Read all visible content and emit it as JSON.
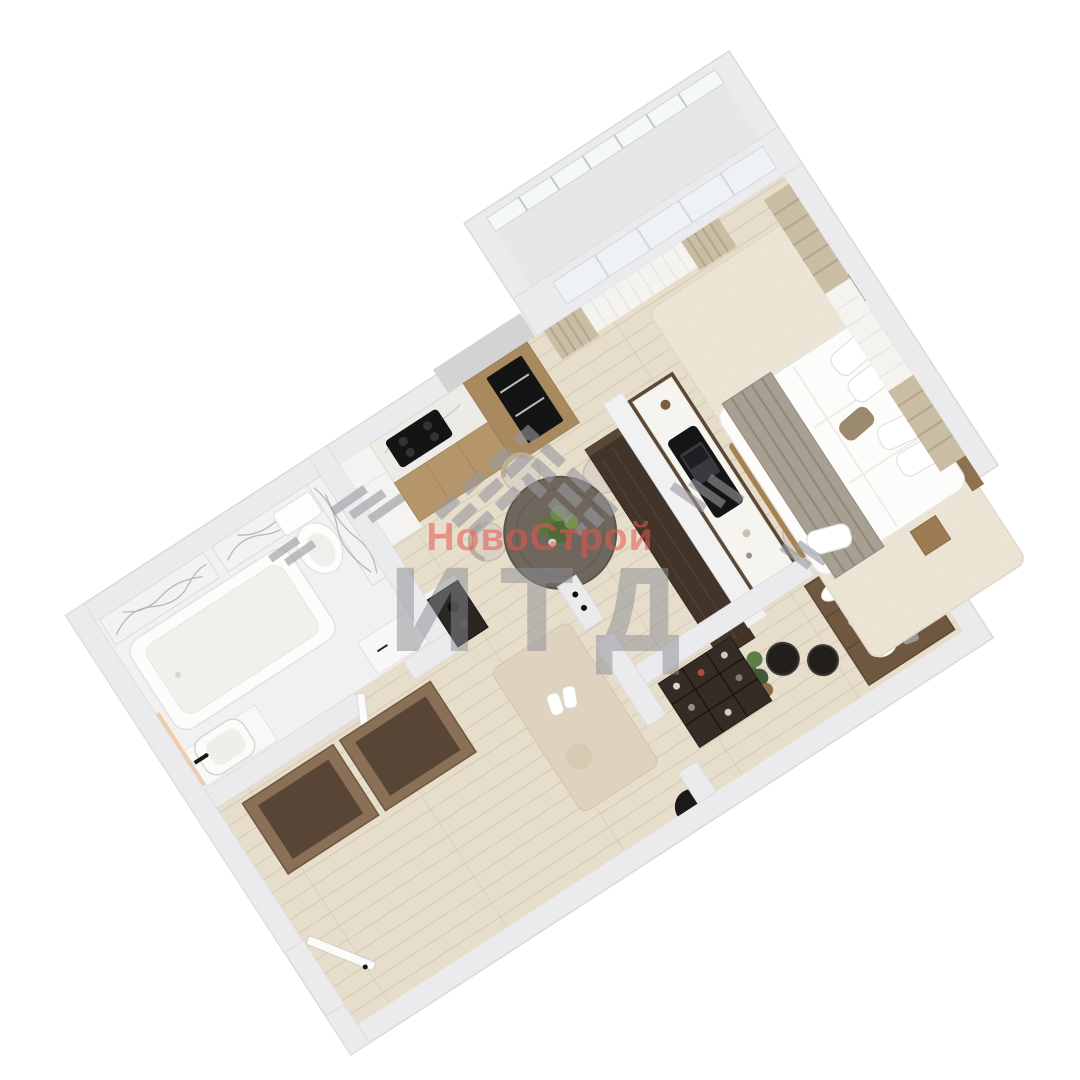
{
  "watermark": {
    "brand_text": "НовоСтрой",
    "abbr_text": "ИТД",
    "brand_color": "#e4574e",
    "abbr_color": "#8e8e95",
    "chevron_color": "#98989f"
  },
  "palette": {
    "wall": "#ebebed",
    "wall_edge": "#d9d9dc",
    "floor_wood": "#e6ddcb",
    "bath_tile": "#f2f1f2",
    "marble_base": "#f3f2f3",
    "kitchen_wood": "#b5966b",
    "tall_cabinet_wood": "#a98a5e",
    "appliance_black": "#141414",
    "counter_marble": "#edebe6",
    "curtain_beige": "#c9bda3",
    "curtain_sheer": "#f4f3f0",
    "dining_table": "#6f675d",
    "chair_beige": "#dad3c5",
    "media_chest": "#43342a",
    "desk_top": "#f6f4ef",
    "bed_white": "#fcfcfb",
    "throw_gray": "#a69f92",
    "rug_beige": "#ece5d6",
    "closet_wood": "#6f5740",
    "basket_black": "#211e1c",
    "plant_green": "#54703f",
    "glass": "#eef2f4"
  }
}
